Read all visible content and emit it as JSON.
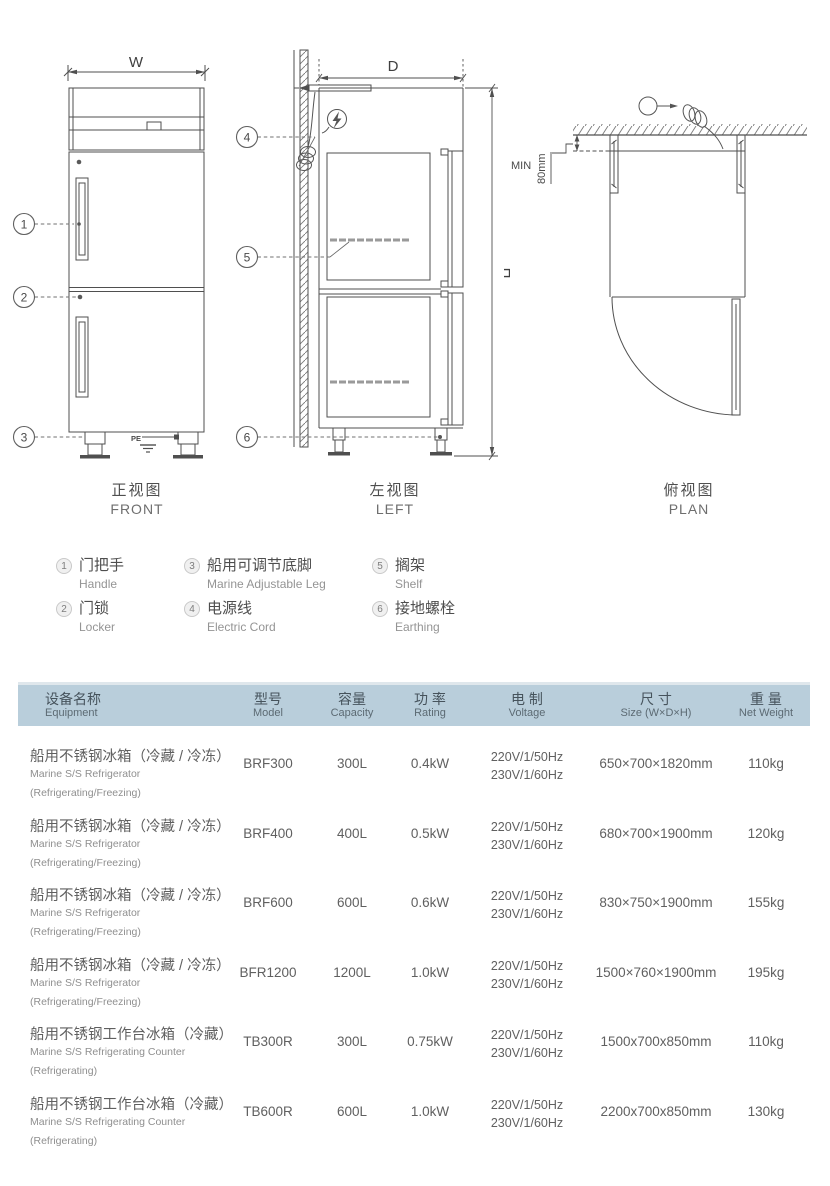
{
  "drawings": {
    "front": {
      "caption_cn": "正视图",
      "caption_en": "FRONT",
      "width_label": "W",
      "pe_label": "PE"
    },
    "left": {
      "caption_cn": "左视图",
      "caption_en": "LEFT",
      "depth_label": "D",
      "height_label": "H"
    },
    "plan": {
      "caption_cn": "俯视图",
      "caption_en": "PLAN",
      "min_label": "MIN",
      "clearance_label": "80mm"
    }
  },
  "callouts": [
    {
      "num": "1",
      "cn": "门把手",
      "en": "Handle"
    },
    {
      "num": "2",
      "cn": "门锁",
      "en": "Locker"
    },
    {
      "num": "3",
      "cn": "船用可调节底脚",
      "en": "Marine Adjustable Leg"
    },
    {
      "num": "4",
      "cn": "电源线",
      "en": "Electric Cord"
    },
    {
      "num": "5",
      "cn": "搁架",
      "en": "Shelf"
    },
    {
      "num": "6",
      "cn": "接地螺栓",
      "en": "Earthing"
    }
  ],
  "table": {
    "header_bg": "#b9cedb",
    "columns": [
      {
        "cn": "设备名称",
        "en": "Equipment"
      },
      {
        "cn": "型号",
        "en": "Model"
      },
      {
        "cn": "容量",
        "en": "Capacity"
      },
      {
        "cn": "功 率",
        "en": "Rating"
      },
      {
        "cn": "电 制",
        "en": "Voltage"
      },
      {
        "cn": "尺 寸",
        "en": "Size (W×D×H)"
      },
      {
        "cn": "重 量",
        "en": "Net Weight"
      }
    ],
    "rows": [
      {
        "name_cn": "船用不锈钢冰箱（冷藏 / 冷冻）",
        "name_en": "Marine S/S Refrigerator",
        "name_sub": "(Refrigerating/Freezing)",
        "model": "BRF300",
        "capacity": "300L",
        "rating": "0.4kW",
        "voltage_1": "220V/1/50Hz",
        "voltage_2": "230V/1/60Hz",
        "size": "650×700×1820mm",
        "weight": "110kg"
      },
      {
        "name_cn": "船用不锈钢冰箱（冷藏 / 冷冻）",
        "name_en": "Marine S/S Refrigerator",
        "name_sub": "(Refrigerating/Freezing)",
        "model": "BRF400",
        "capacity": "400L",
        "rating": "0.5kW",
        "voltage_1": "220V/1/50Hz",
        "voltage_2": "230V/1/60Hz",
        "size": "680×700×1900mm",
        "weight": "120kg"
      },
      {
        "name_cn": "船用不锈钢冰箱（冷藏 / 冷冻）",
        "name_en": "Marine S/S Refrigerator",
        "name_sub": "(Refrigerating/Freezing)",
        "model": "BRF600",
        "capacity": "600L",
        "rating": "0.6kW",
        "voltage_1": "220V/1/50Hz",
        "voltage_2": "230V/1/60Hz",
        "size": "830×750×1900mm",
        "weight": "155kg"
      },
      {
        "name_cn": "船用不锈钢冰箱（冷藏 / 冷冻）",
        "name_en": "Marine S/S Refrigerator",
        "name_sub": "(Refrigerating/Freezing)",
        "model": "BFR1200",
        "capacity": "1200L",
        "rating": "1.0kW",
        "voltage_1": "220V/1/50Hz",
        "voltage_2": "230V/1/60Hz",
        "size": "1500×760×1900mm",
        "weight": "195kg"
      },
      {
        "name_cn": "船用不锈钢工作台冰箱（冷藏）",
        "name_en": "Marine S/S Refrigerating Counter",
        "name_sub": "(Refrigerating)",
        "model": "TB300R",
        "capacity": "300L",
        "rating": "0.75kW",
        "voltage_1": "220V/1/50Hz",
        "voltage_2": "230V/1/60Hz",
        "size": "1500x700x850mm",
        "weight": "110kg"
      },
      {
        "name_cn": "船用不锈钢工作台冰箱（冷藏）",
        "name_en": "Marine S/S Refrigerating Counter",
        "name_sub": "(Refrigerating)",
        "model": "TB600R",
        "capacity": "600L",
        "rating": "1.0kW",
        "voltage_1": "220V/1/50Hz",
        "voltage_2": "230V/1/60Hz",
        "size": "2200x700x850mm",
        "weight": "130kg"
      }
    ]
  }
}
